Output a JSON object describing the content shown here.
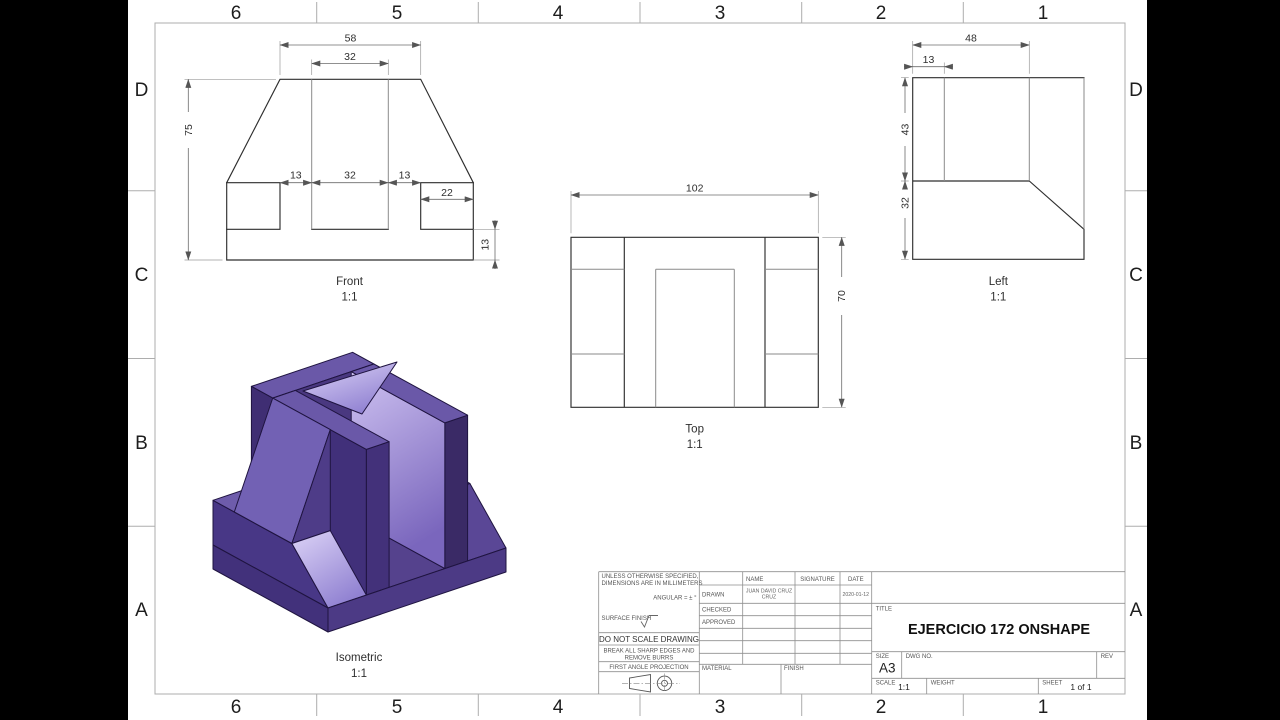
{
  "sheet": {
    "grid": {
      "cols": [
        "6",
        "5",
        "4",
        "3",
        "2",
        "1"
      ],
      "rows": [
        "D",
        "C",
        "B",
        "A"
      ]
    }
  },
  "views": {
    "front": {
      "label": "Front",
      "scale": "1:1",
      "dims": {
        "top_width": "58",
        "slot_width": "32",
        "height": "75",
        "mid_left": "13",
        "mid_center": "32",
        "mid_right": "13",
        "wing_width": "22",
        "base_height": "13"
      }
    },
    "top": {
      "label": "Top",
      "scale": "1:1",
      "dims": {
        "width": "102",
        "depth": "70"
      }
    },
    "left": {
      "label": "Left",
      "scale": "1:1",
      "dims": {
        "depth": "48",
        "wall": "13",
        "upper_height": "43",
        "lower_height": "32"
      }
    },
    "iso": {
      "label": "Isometric",
      "scale": "1:1"
    }
  },
  "title_block": {
    "spec_line1": "UNLESS OTHERWISE SPECIFIED,",
    "spec_line2": "DIMENSIONS ARE IN MILLIMETERS",
    "angular": "ANGULAR = ± °",
    "surface_finish": "SURFACE FINISH",
    "do_not_scale": "DO NOT SCALE DRAWING",
    "break_edges_1": "BREAK ALL SHARP EDGES AND",
    "break_edges_2": "REMOVE BURRS",
    "projection": "FIRST ANGLE PROJECTION",
    "material_label": "MATERIAL",
    "finish_label": "FINISH",
    "name_header": "NAME",
    "signature_header": "SIGNATURE",
    "date_header": "DATE",
    "drawn_label": "DRAWN",
    "checked_label": "CHECKED",
    "approved_label": "APPROVED",
    "drawn_name_line1": "JUAN DAVID CRUZ",
    "drawn_name_line2": "CRUZ",
    "drawn_date": "2020-01-12",
    "title_label": "TITLE",
    "title": "EJERCICIO 172 ONSHAPE",
    "size_label": "SIZE",
    "size": "A3",
    "dwg_label": "DWG NO.",
    "rev_label": "REV",
    "scale_label": "SCALE",
    "scale": "1:1",
    "weight_label": "WEIGHT",
    "sheet_label": "SHEET",
    "sheet": "1 of 1"
  },
  "colors": {
    "part_dark": "#362963",
    "part_mid": "#5e4da0",
    "part_light": "#cfc3f3",
    "line": "#2e2e2e"
  }
}
